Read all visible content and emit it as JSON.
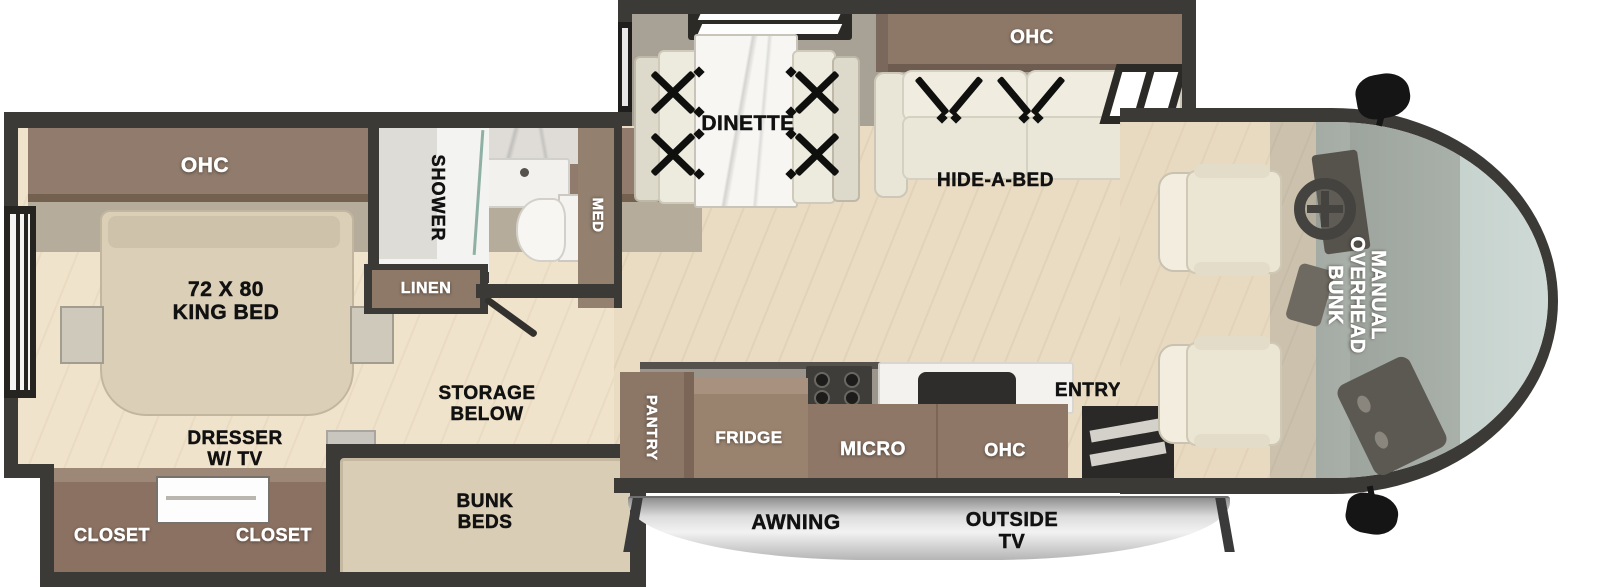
{
  "colors": {
    "wall": "#3c3a37",
    "cabinet_brown": "#8e7768",
    "floor_tan": "#e9dcc3",
    "mattress_tan": "#d9cdb5",
    "upholstery_cream": "#edeadd",
    "windshield_glass": "#bccac5",
    "awning_silver": "#d9d9d9",
    "strap_black": "#0f0f0e"
  },
  "plan": {
    "bedroom": {
      "ohc": "OHC",
      "bed": [
        "72 X 80",
        "KING BED"
      ],
      "dresser": [
        "DRESSER",
        "W/ TV"
      ],
      "closet_left": "CLOSET",
      "closet_right": "CLOSET"
    },
    "bathroom": {
      "shower": "SHOWER",
      "med": "MED",
      "linen": "LINEN"
    },
    "bunk_room": {
      "storage": [
        "STORAGE",
        "BELOW"
      ],
      "bunks": [
        "BUNK",
        "BEDS"
      ]
    },
    "slideout": {
      "dinette": "DINETTE",
      "ohc": "OHC",
      "hide_a_bed": "HIDE-A-BED"
    },
    "kitchen": {
      "pantry": "PANTRY",
      "fridge": "FRIDGE",
      "micro": "MICRO",
      "ohc": "OHC",
      "entry": "ENTRY"
    },
    "exterior": {
      "awning": "AWNING",
      "outside_tv": [
        "OUTSIDE",
        "TV"
      ]
    },
    "cab": {
      "overhead_bunk": [
        "MANUAL",
        "OVERHEAD",
        "BUNK"
      ]
    }
  }
}
